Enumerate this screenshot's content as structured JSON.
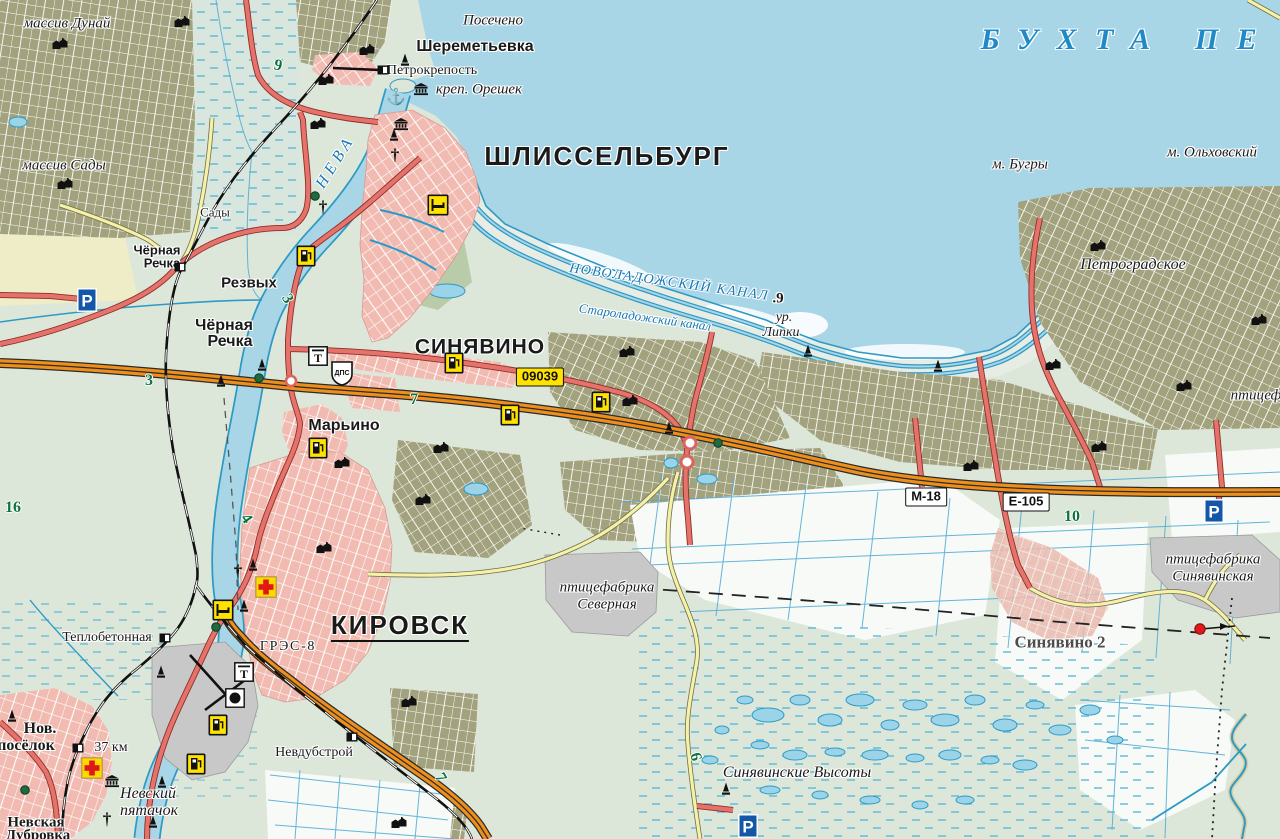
{
  "map": {
    "colors": {
      "water": "#A8D6E6",
      "land": "#DCE7DA",
      "garden_plots": "#A2A27E",
      "urban": "#F1BBB2",
      "industrial": "#C8C8C8",
      "road_orange": "#EE8F1C",
      "road_red": "#E5736C",
      "road_yellow": "#F6F1A6",
      "water_line": "#2D9AC6",
      "water_label": "#1778B5",
      "km_green": "#0E7240",
      "shield_yellow": "#FFE200"
    },
    "labels": [
      {
        "t": "массив Дунай",
        "x": 67,
        "y": 24,
        "c": "ser-i",
        "s": 15
      },
      {
        "t": "массив Сады",
        "x": 64,
        "y": 166,
        "c": "ser-i",
        "s": 15
      },
      {
        "t": "Посечено",
        "x": 493,
        "y": 21,
        "c": "ser-i",
        "s": 15
      },
      {
        "t": "Шереметьевка",
        "x": 475,
        "y": 47,
        "c": "vil-b",
        "s": 16
      },
      {
        "t": "Петрокрепость",
        "x": 432,
        "y": 71,
        "c": "ser",
        "s": 14
      },
      {
        "t": "креп. Орешек",
        "x": 479,
        "y": 90,
        "c": "ser-i",
        "s": 15
      },
      {
        "t": "ШЛИССЕЛЬБУРГ",
        "x": 607,
        "y": 156,
        "c": "city",
        "s": 26
      },
      {
        "t": "НЕВА",
        "x": 336,
        "y": 162,
        "c": "wat",
        "s": 16,
        "r": -58,
        "ls": 0.3
      },
      {
        "t": "БУХТА ПЕ",
        "x": 1128,
        "y": 40,
        "c": "wat-xl",
        "s": 30,
        "ls": 0.62
      },
      {
        "t": "м. Бугры",
        "x": 1020,
        "y": 165,
        "c": "ser-i",
        "s": 15
      },
      {
        "t": "м. Ольховский",
        "x": 1212,
        "y": 153,
        "c": "ser-i",
        "s": 15
      },
      {
        "t": "НОВОЛАДОЖСКИЙ КАНАЛ",
        "x": 669,
        "y": 283,
        "c": "wat",
        "s": 14,
        "r": 8,
        "ls": 0.1
      },
      {
        "t": ".9",
        "x": 778,
        "y": 299,
        "c": "blk-num",
        "s": 15
      },
      {
        "t": "Староладожский канал",
        "x": 645,
        "y": 317,
        "c": "wat",
        "s": 13,
        "r": 8
      },
      {
        "t": "ур.",
        "x": 784,
        "y": 318,
        "c": "ser-i",
        "s": 14
      },
      {
        "t": "Липки",
        "x": 781,
        "y": 333,
        "c": "ser-i",
        "s": 14
      },
      {
        "t": "Петроградское",
        "x": 1133,
        "y": 265,
        "c": "ser-i",
        "s": 16
      },
      {
        "t": "птицеф",
        "x": 1256,
        "y": 396,
        "c": "ser-i",
        "s": 15
      },
      {
        "t": "СИНЯВИНО",
        "x": 480,
        "y": 347,
        "c": "town",
        "s": 21
      },
      {
        "t": "Чёрная",
        "x": 157,
        "y": 250,
        "c": "vil-s",
        "s": 13
      },
      {
        "t": "Речка",
        "x": 162,
        "y": 263,
        "c": "vil-s",
        "s": 13
      },
      {
        "t": "Сады",
        "x": 215,
        "y": 212,
        "c": "ser",
        "s": 13
      },
      {
        "t": "Резвых",
        "x": 249,
        "y": 283,
        "c": "vil-b",
        "s": 15
      },
      {
        "t": "Чёрная",
        "x": 224,
        "y": 326,
        "c": "vil-b",
        "s": 16
      },
      {
        "t": "Речка",
        "x": 230,
        "y": 342,
        "c": "vil-b",
        "s": 16
      },
      {
        "t": "Марьино",
        "x": 344,
        "y": 426,
        "c": "vil-b",
        "s": 16
      },
      {
        "t": "КИРОВСК",
        "x": 400,
        "y": 627,
        "c": "city under",
        "s": 26
      },
      {
        "t": "ГРЭС-8",
        "x": 288,
        "y": 647,
        "c": "ser",
        "s": 14,
        "ls": 0.12
      },
      {
        "t": "Теплобетонная",
        "x": 107,
        "y": 638,
        "c": "ser",
        "s": 14
      },
      {
        "t": "Нов.",
        "x": 40,
        "y": 729,
        "c": "vil-ser",
        "s": 16
      },
      {
        "t": "посёлок",
        "x": 26,
        "y": 746,
        "c": "vil-ser",
        "s": 16
      },
      {
        "t": "37 км",
        "x": 111,
        "y": 748,
        "c": "ser",
        "s": 14
      },
      {
        "t": "Невский",
        "x": 148,
        "y": 794,
        "c": "ser-i",
        "s": 16
      },
      {
        "t": "пятачок",
        "x": 149,
        "y": 811,
        "c": "ser-i",
        "s": 16
      },
      {
        "t": "Невская",
        "x": 36,
        "y": 823,
        "c": "vil-ser",
        "s": 15
      },
      {
        "t": "Дубровка",
        "x": 38,
        "y": 836,
        "c": "vil-ser",
        "s": 15
      },
      {
        "t": "Невдубстрой",
        "x": 314,
        "y": 753,
        "c": "ser",
        "s": 14
      },
      {
        "t": "Синявинские Высоты",
        "x": 797,
        "y": 773,
        "c": "ser-i",
        "s": 16
      },
      {
        "t": "Синявино 2",
        "x": 1060,
        "y": 642,
        "c": "ser-b",
        "s": 17
      },
      {
        "t": "птицефабрика",
        "x": 1213,
        "y": 560,
        "c": "ser-i",
        "s": 15
      },
      {
        "t": "Синявинская",
        "x": 1213,
        "y": 577,
        "c": "ser-i",
        "s": 15
      },
      {
        "t": "птицефабрика",
        "x": 607,
        "y": 588,
        "c": "ser-i",
        "s": 15
      },
      {
        "t": "Северная",
        "x": 607,
        "y": 605,
        "c": "ser-i",
        "s": 15
      }
    ],
    "road_shields": [
      {
        "t": "09039",
        "x": 540,
        "y": 377,
        "style": "yellow"
      },
      {
        "t": "М-18",
        "x": 926,
        "y": 497,
        "style": "white"
      },
      {
        "t": "Е-105",
        "x": 1026,
        "y": 502,
        "style": "white"
      }
    ],
    "km_markers": [
      {
        "t": "9",
        "x": 278,
        "y": 66,
        "r": 12
      },
      {
        "t": "3",
        "x": 287,
        "y": 299,
        "r": 60
      },
      {
        "t": "3",
        "x": 149,
        "y": 381,
        "r": 0
      },
      {
        "t": "16",
        "x": 13,
        "y": 508,
        "r": 0
      },
      {
        "t": "7",
        "x": 414,
        "y": 400,
        "r": 0
      },
      {
        "t": "4",
        "x": 246,
        "y": 519,
        "r": 55
      },
      {
        "t": "10",
        "x": 1072,
        "y": 517,
        "r": 0
      },
      {
        "t": "6",
        "x": 695,
        "y": 757,
        "r": 75
      },
      {
        "t": "7",
        "x": 440,
        "y": 778,
        "r": 60
      }
    ],
    "icons": [
      {
        "type": "anchor-icon",
        "x": 396,
        "y": 98,
        "glyph": "⚓"
      },
      {
        "type": "museum-icon",
        "x": 421,
        "y": 89
      },
      {
        "type": "museum-icon",
        "x": 401,
        "y": 124
      },
      {
        "type": "museum-icon",
        "x": 112,
        "y": 781
      },
      {
        "type": "church-icon",
        "x": 395,
        "y": 155,
        "glyph": "†"
      },
      {
        "type": "church-icon",
        "x": 323,
        "y": 207,
        "glyph": "†"
      },
      {
        "type": "church-icon",
        "x": 238,
        "y": 571,
        "glyph": "†"
      },
      {
        "type": "church-icon",
        "x": 107,
        "y": 819,
        "glyph": "†"
      },
      {
        "type": "monument-icon",
        "x": 405,
        "y": 60
      },
      {
        "type": "monument-icon",
        "x": 394,
        "y": 135
      },
      {
        "type": "monument-icon",
        "x": 262,
        "y": 365
      },
      {
        "type": "monument-icon",
        "x": 221,
        "y": 381
      },
      {
        "type": "monument-icon",
        "x": 808,
        "y": 351
      },
      {
        "type": "monument-icon",
        "x": 938,
        "y": 366
      },
      {
        "type": "monument-icon",
        "x": 669,
        "y": 428
      },
      {
        "type": "monument-icon",
        "x": 253,
        "y": 565
      },
      {
        "type": "monument-icon",
        "x": 244,
        "y": 606
      },
      {
        "type": "monument-icon",
        "x": 161,
        "y": 672
      },
      {
        "type": "monument-icon",
        "x": 12,
        "y": 716
      },
      {
        "type": "monument-icon",
        "x": 162,
        "y": 782
      },
      {
        "type": "monument-icon",
        "x": 153,
        "y": 822
      },
      {
        "type": "monument-icon",
        "x": 726,
        "y": 789
      },
      {
        "type": "hotel-icon",
        "x": 438,
        "y": 205
      },
      {
        "type": "hotel-icon",
        "x": 223,
        "y": 610
      },
      {
        "type": "gas-station-icon",
        "x": 306,
        "y": 256
      },
      {
        "type": "gas-station-icon",
        "x": 454,
        "y": 363
      },
      {
        "type": "gas-station-icon",
        "x": 510,
        "y": 415
      },
      {
        "type": "gas-station-icon",
        "x": 601,
        "y": 402
      },
      {
        "type": "gas-station-icon",
        "x": 318,
        "y": 448
      },
      {
        "type": "gas-station-icon",
        "x": 218,
        "y": 725
      },
      {
        "type": "gas-station-icon",
        "x": 196,
        "y": 764
      },
      {
        "type": "hospital-icon",
        "x": 266,
        "y": 587
      },
      {
        "type": "hospital-icon",
        "x": 92,
        "y": 768
      },
      {
        "type": "parking-icon",
        "x": 87,
        "y": 300,
        "glyph": "P"
      },
      {
        "type": "parking-icon",
        "x": 1214,
        "y": 511,
        "glyph": "P"
      },
      {
        "type": "parking-icon",
        "x": 748,
        "y": 826,
        "glyph": "P"
      },
      {
        "type": "dps-post-icon",
        "x": 342,
        "y": 373,
        "glyph": "ДПС"
      },
      {
        "type": "memorial-icon",
        "x": 244,
        "y": 672,
        "glyph": "Т"
      },
      {
        "type": "memorial-icon",
        "x": 318,
        "y": 356,
        "glyph": "Т"
      },
      {
        "type": "railway-station-icon",
        "x": 383,
        "y": 70
      },
      {
        "type": "railway-station-icon",
        "x": 180,
        "y": 267
      },
      {
        "type": "railway-station-icon",
        "x": 165,
        "y": 638
      },
      {
        "type": "railway-station-icon",
        "x": 78,
        "y": 748
      },
      {
        "type": "railway-station-icon",
        "x": 352,
        "y": 737
      },
      {
        "type": "factory-icon",
        "x": 235,
        "y": 698
      },
      {
        "type": "windsock-icon",
        "x": 1215,
        "y": 629
      },
      {
        "type": "marker-dot-icon",
        "x": 315,
        "y": 196
      },
      {
        "type": "marker-dot-icon",
        "x": 259,
        "y": 378
      },
      {
        "type": "marker-dot-icon",
        "x": 216,
        "y": 627
      },
      {
        "type": "marker-dot-icon",
        "x": 718,
        "y": 443
      },
      {
        "type": "marker-dot-icon",
        "x": 25,
        "y": 790
      },
      {
        "type": "buildings-icon",
        "x": 182,
        "y": 22
      },
      {
        "type": "buildings-icon",
        "x": 60,
        "y": 44
      },
      {
        "type": "buildings-icon",
        "x": 367,
        "y": 50
      },
      {
        "type": "buildings-icon",
        "x": 326,
        "y": 80
      },
      {
        "type": "buildings-icon",
        "x": 318,
        "y": 124
      },
      {
        "type": "buildings-icon",
        "x": 65,
        "y": 184
      },
      {
        "type": "buildings-icon",
        "x": 627,
        "y": 352
      },
      {
        "type": "buildings-icon",
        "x": 630,
        "y": 401
      },
      {
        "type": "buildings-icon",
        "x": 342,
        "y": 463
      },
      {
        "type": "buildings-icon",
        "x": 441,
        "y": 448
      },
      {
        "type": "buildings-icon",
        "x": 423,
        "y": 500
      },
      {
        "type": "buildings-icon",
        "x": 324,
        "y": 548
      },
      {
        "type": "buildings-icon",
        "x": 971,
        "y": 466
      },
      {
        "type": "buildings-icon",
        "x": 1099,
        "y": 447
      },
      {
        "type": "buildings-icon",
        "x": 1098,
        "y": 246
      },
      {
        "type": "buildings-icon",
        "x": 1053,
        "y": 365
      },
      {
        "type": "buildings-icon",
        "x": 1259,
        "y": 320
      },
      {
        "type": "buildings-icon",
        "x": 1184,
        "y": 386
      },
      {
        "type": "buildings-icon",
        "x": 409,
        "y": 702
      },
      {
        "type": "buildings-icon",
        "x": 399,
        "y": 823
      }
    ]
  }
}
